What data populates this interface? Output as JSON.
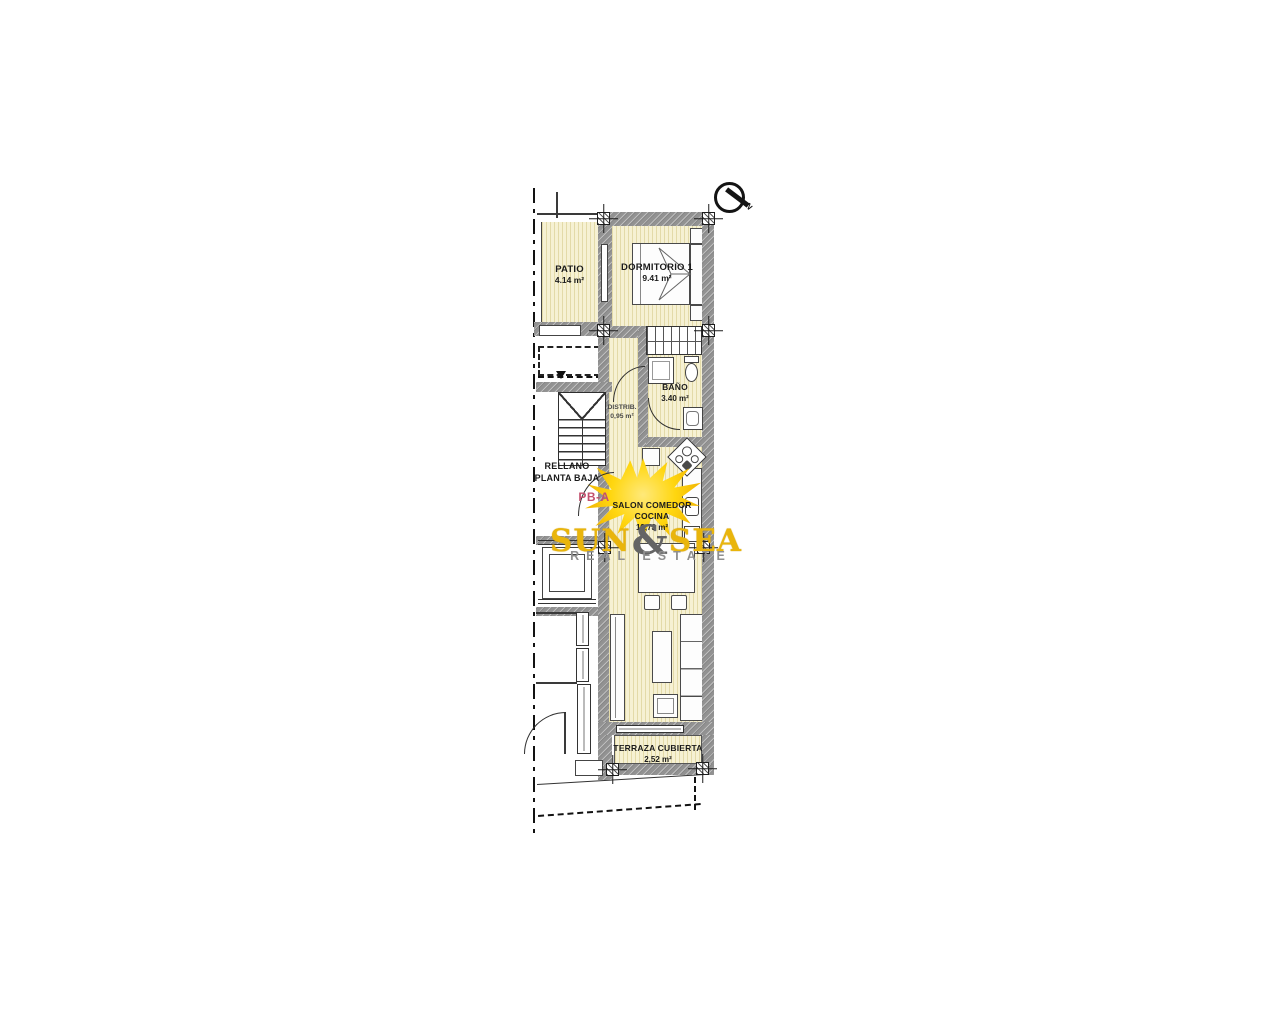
{
  "plan": {
    "unit_label": "PB-A",
    "landing": {
      "line1": "RELLANO",
      "line2": "PLANTA BAJA"
    },
    "compass": {
      "label": "N"
    },
    "rooms": {
      "patio": {
        "name": "PATIO",
        "area": "4.14 m²"
      },
      "dormitorio1": {
        "name": "DORMITORIO 1",
        "area": "9.41 m²"
      },
      "bano": {
        "name": "BAÑO",
        "area": "3.40 m²"
      },
      "distribuidor": {
        "name": "DISTRIB.",
        "area": "0,95 m²"
      },
      "salon": {
        "name_line1": "SALON COMEDOR",
        "name_line2": "COCINA",
        "area": "19,73 m²"
      },
      "terraza": {
        "name": "TERRAZA CUBIERTA",
        "area": "2,52 m²"
      }
    },
    "colors": {
      "room_fill": "#f6f1d3",
      "room_stripe": "#e3daa8",
      "wall_gray": "#929292",
      "line": "#2f2f2f",
      "unit_label_color": "#c2506e"
    }
  },
  "watermark": {
    "brand_word1": "SUN",
    "brand_amp": "&",
    "brand_word2": "SEA",
    "tagline": "REAL ESTATE",
    "brand_color": "#e9b50c",
    "amp_color": "#646464",
    "tagline_color": "#8f8f8f",
    "sun_color": "#ffd60f"
  }
}
